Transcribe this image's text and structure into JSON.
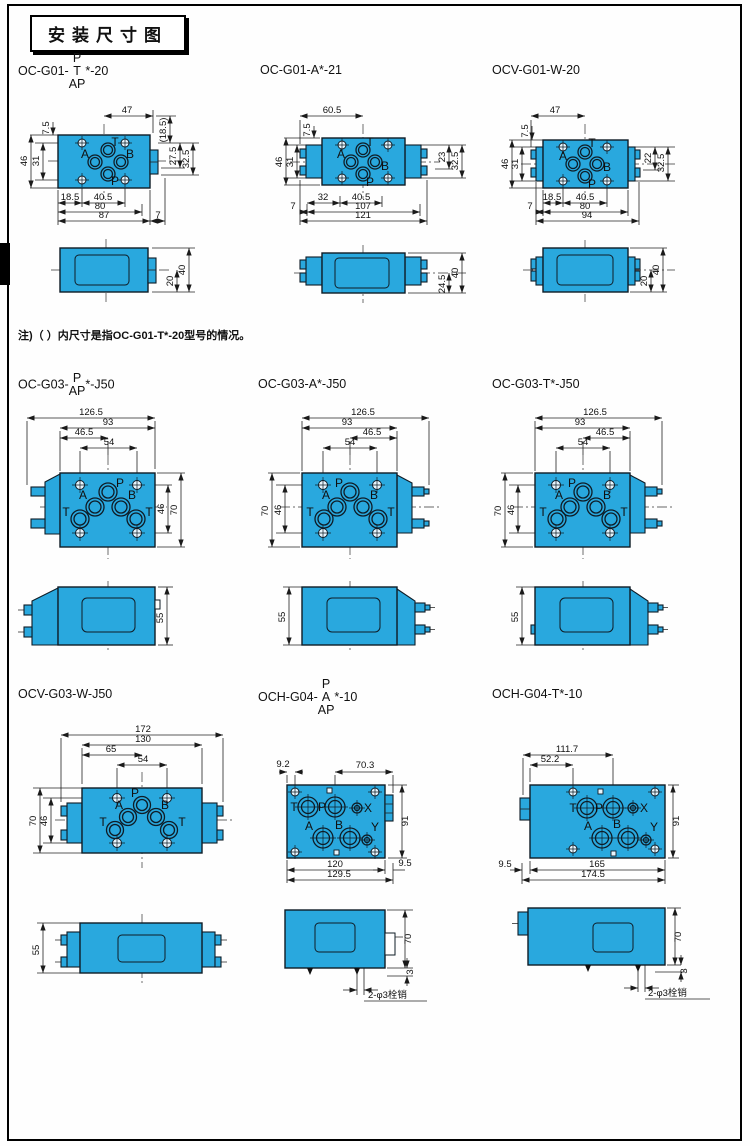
{
  "page": {
    "title": "安装尺寸图",
    "note": "注)（ ）内尺寸是指OC-G01-T*-20型号的情况。"
  },
  "models": {
    "d1": {
      "pre": "OC-G01-",
      "sup": "P",
      "mid": "T",
      "sub": "AP",
      "post": "*-20"
    },
    "d2": {
      "label": "OC-G01-A*-21"
    },
    "d3": {
      "label": "OCV-G01-W-20"
    },
    "d4": {
      "pre": "OC-G03-",
      "sup": "P",
      "sub": "AP",
      "post": "*-J50"
    },
    "d5": {
      "label": "OC-G03-A*-J50"
    },
    "d6": {
      "label": "OC-G03-T*-J50"
    },
    "d7": {
      "label": "OCV-G03-W-J50"
    },
    "d8": {
      "pre": "OCH-G04-",
      "sup": "P",
      "mid": "A",
      "sub": "AP",
      "post": "*-10"
    },
    "d9": {
      "label": "OCH-G04-T*-10"
    }
  },
  "d1": {
    "ports": {
      "t": "T",
      "a": "A",
      "b": "B",
      "p": "P"
    },
    "dims": {
      "w47": "47",
      "p185": "(18.5)",
      "h75": "7.5",
      "h46": "46",
      "h31": "31",
      "r275": "27.5",
      "r325": "32.5",
      "b185": "18.5",
      "b405": "40.5",
      "b80": "80",
      "b87": "87",
      "b7": "7"
    },
    "side": {
      "s20": "20",
      "s40": "40"
    }
  },
  "d2": {
    "ports": {
      "t": "T",
      "a": "A",
      "b": "B",
      "p": "P"
    },
    "dims": {
      "w605": "60.5",
      "h75": "7.5",
      "h46": "46",
      "h31": "31",
      "r23": "23",
      "r325": "32.5",
      "b32": "32",
      "b405": "40.5",
      "b107": "107",
      "b121": "121",
      "b7": "7"
    },
    "side": {
      "s245": "24.5",
      "s40": "40"
    }
  },
  "d3": {
    "ports": {
      "t": "T",
      "a": "A",
      "b": "B",
      "p": "P"
    },
    "dims": {
      "w47": "47",
      "h75": "7.5",
      "h46": "46",
      "h31": "31",
      "r22": "22",
      "r325": "32.5",
      "b185": "18.5",
      "b405": "40.5",
      "b80": "80",
      "b94": "94",
      "b7": "7"
    },
    "side": {
      "s20": "20",
      "s40": "40"
    }
  },
  "d4": {
    "ports": {
      "p": "P",
      "a": "A",
      "b": "B",
      "t1": "T",
      "t2": "T"
    },
    "dims": {
      "w1265": "126.5",
      "w93": "93",
      "w465": "46.5",
      "w54": "54",
      "r46": "46",
      "r70": "70"
    },
    "side": {
      "s55": "55"
    }
  },
  "d5": {
    "ports": {
      "p": "P",
      "a": "A",
      "b": "B",
      "t1": "T",
      "t2": "T"
    },
    "dims": {
      "w1265": "126.5",
      "w93": "93",
      "w465": "46.5",
      "w54": "54",
      "l70": "70",
      "l46": "46"
    },
    "side": {
      "s55": "55"
    }
  },
  "d6": {
    "ports": {
      "p": "P",
      "a": "A",
      "b": "B",
      "t1": "T",
      "t2": "T"
    },
    "dims": {
      "w1265": "126.5",
      "w93": "93",
      "w465": "46.5",
      "w54": "54",
      "l70": "70",
      "l46": "46"
    },
    "side": {
      "s55": "55"
    }
  },
  "d7": {
    "ports": {
      "p": "P",
      "a": "A",
      "b": "B",
      "t1": "T",
      "t2": "T"
    },
    "dims": {
      "w172": "172",
      "w130": "130",
      "w65": "65",
      "w54": "54",
      "l70": "70",
      "l46": "46"
    },
    "side": {
      "s55": "55"
    }
  },
  "d8": {
    "ports": {
      "t": "T",
      "p": "P",
      "x": "X",
      "a": "A",
      "b": "B",
      "y": "Y"
    },
    "dims": {
      "w92": "9.2",
      "w703": "70.3",
      "r91": "91",
      "b120": "120",
      "b1295": "129.5",
      "b95": "9.5"
    },
    "side": {
      "s70": "70",
      "s3": "3",
      "pin": "2-φ3栓销"
    }
  },
  "d9": {
    "ports": {
      "t": "T",
      "p": "P",
      "x": "X",
      "a": "A",
      "b": "B",
      "y": "Y"
    },
    "dims": {
      "w1117": "111.7",
      "w522": "52.2",
      "r91": "91",
      "b165": "165",
      "b1745": "174.5",
      "b95": "9.5"
    },
    "side": {
      "s70": "70",
      "s3": "3",
      "pin": "2-φ3栓销"
    }
  }
}
